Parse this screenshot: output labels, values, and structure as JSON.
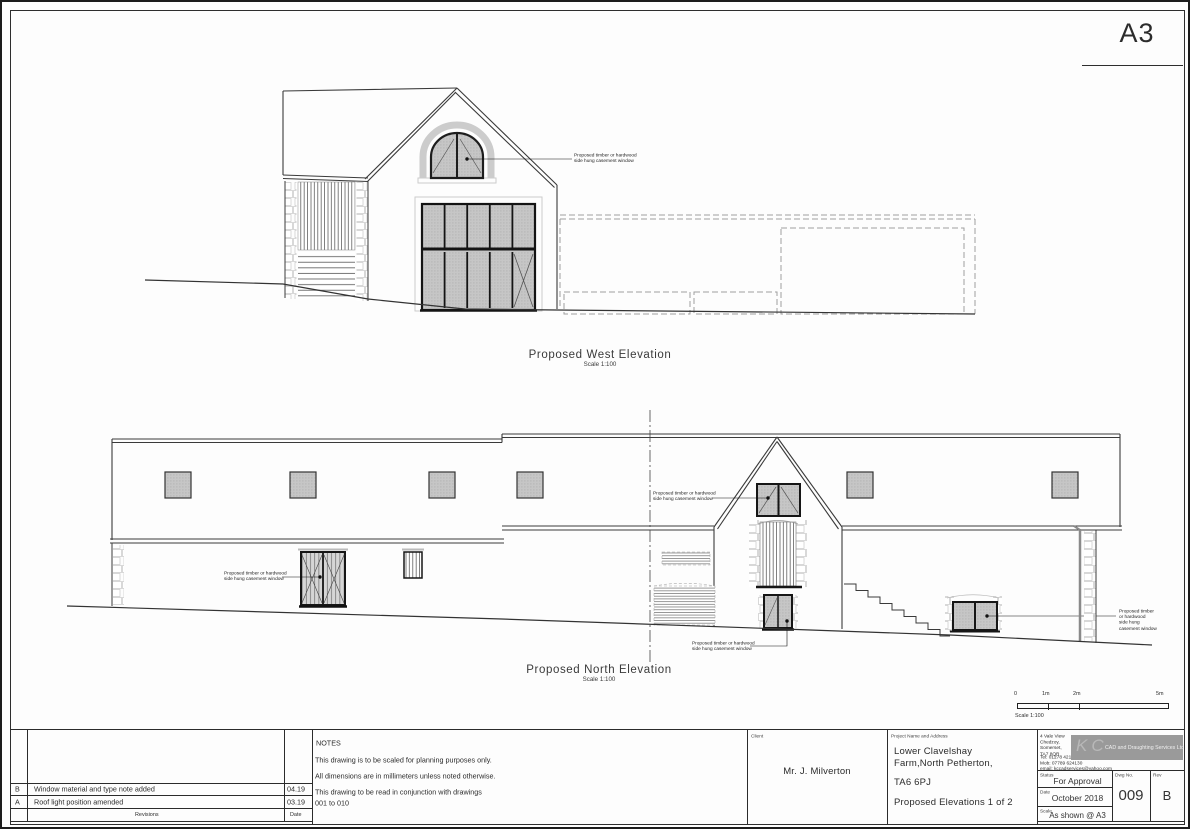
{
  "sheet": {
    "format": "A3"
  },
  "annotation_note": "Proposed timber or hardwood\nside hung casement window",
  "west": {
    "title": "Proposed West Elevation",
    "scale_note": "Scale 1:100"
  },
  "north": {
    "title": "Proposed North Elevation",
    "scale_note": "Scale 1:100"
  },
  "scale_bar": {
    "t0": "0",
    "t1": "1m",
    "t2": "2m",
    "t5": "5m",
    "label": "Scale 1:100"
  },
  "title_block": {
    "notes": {
      "heading": "NOTES",
      "line1": "This drawing is to be scaled for planning purposes only.",
      "line2": "All dimensions are in millimeters unless noted otherwise.",
      "line3": "This drawing to be read in conjunction with drawings\n001 to 010"
    },
    "revisions": {
      "footer_label": "Revisions",
      "date_label": "Date",
      "rows": [
        {
          "rev": "B",
          "description": "Window material and type note added",
          "date": "04.19"
        },
        {
          "rev": "A",
          "description": "Roof light position amended",
          "date": "03.19"
        }
      ]
    },
    "client": {
      "label": "Client",
      "name": "Mr. J. Milverton"
    },
    "project": {
      "label": "Project Name and Address",
      "line1": "Lower Clavelshay",
      "line2": "Farm,North Petherton,",
      "line3": "TA6 6PJ",
      "line4": "Proposed Elevations 1 of 2"
    },
    "company": {
      "address": "4 Vale View\nChedzoy,\nSomerset,\nTA7 8QR",
      "contact": "Tel:  01278 421690\nMob: 07789 624130\nemail: kccadservices@yahoo.com",
      "logo_monogram": "KC",
      "logo_text": "CAD and Draughting Services Ltd"
    },
    "status": {
      "label": "Status",
      "value": "For Approval"
    },
    "date": {
      "label": "Date",
      "value": "October 2018"
    },
    "scale": {
      "label": "Scale",
      "value": "As shown @ A3"
    },
    "dwg": {
      "label": "Dwg No.",
      "value": "009"
    },
    "rev": {
      "label": "Rev",
      "value": "B"
    }
  }
}
